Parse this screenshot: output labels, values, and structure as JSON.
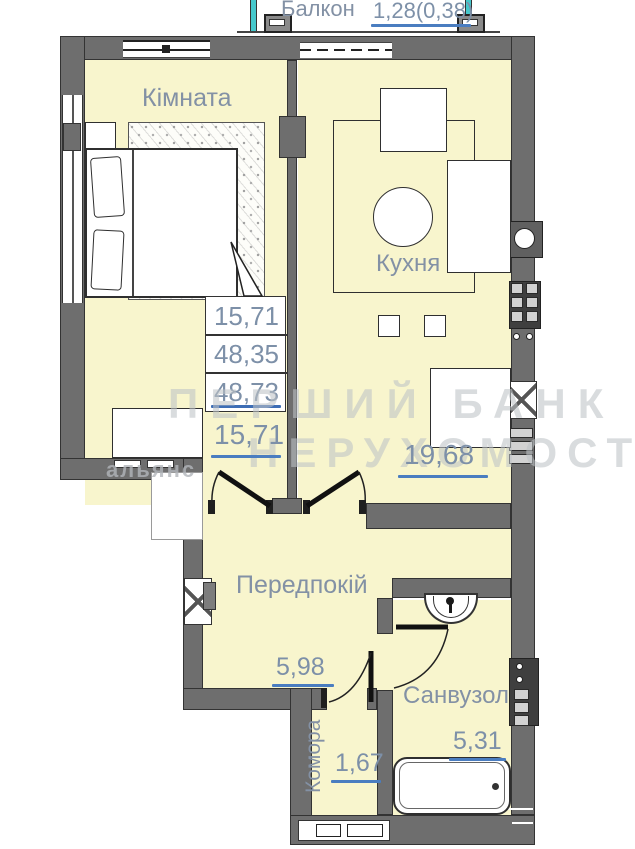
{
  "plan": {
    "balcony": {
      "label": "Балкон",
      "value": "1,28(0,38)"
    },
    "stamp": {
      "rows": [
        "15,71",
        "48,35",
        "48,73"
      ]
    },
    "rooms": {
      "kimnata": {
        "label": "Кімната",
        "area": "15,71"
      },
      "kukhnya": {
        "label": "Кухня",
        "area": "19,68"
      },
      "peredpokii": {
        "label": "Передпокій",
        "area": "5,98"
      },
      "komora": {
        "label": "Комора",
        "area": "1,67"
      },
      "sanvuzol": {
        "label": "Санвузол",
        "area": "5,31"
      }
    },
    "watermark": {
      "line1": "ПЕРШИЙ БАНК",
      "line2": "НЕРУХОМОСТІ",
      "line3": "альянс"
    },
    "colors": {
      "room_fill": "#f8f5cd",
      "wall": "#6e6e6e",
      "label_text": "#8391a5",
      "underline": "#4a7dc0",
      "balcony_accent": "#45c8cc",
      "watermark": "#c2c5c9"
    }
  }
}
